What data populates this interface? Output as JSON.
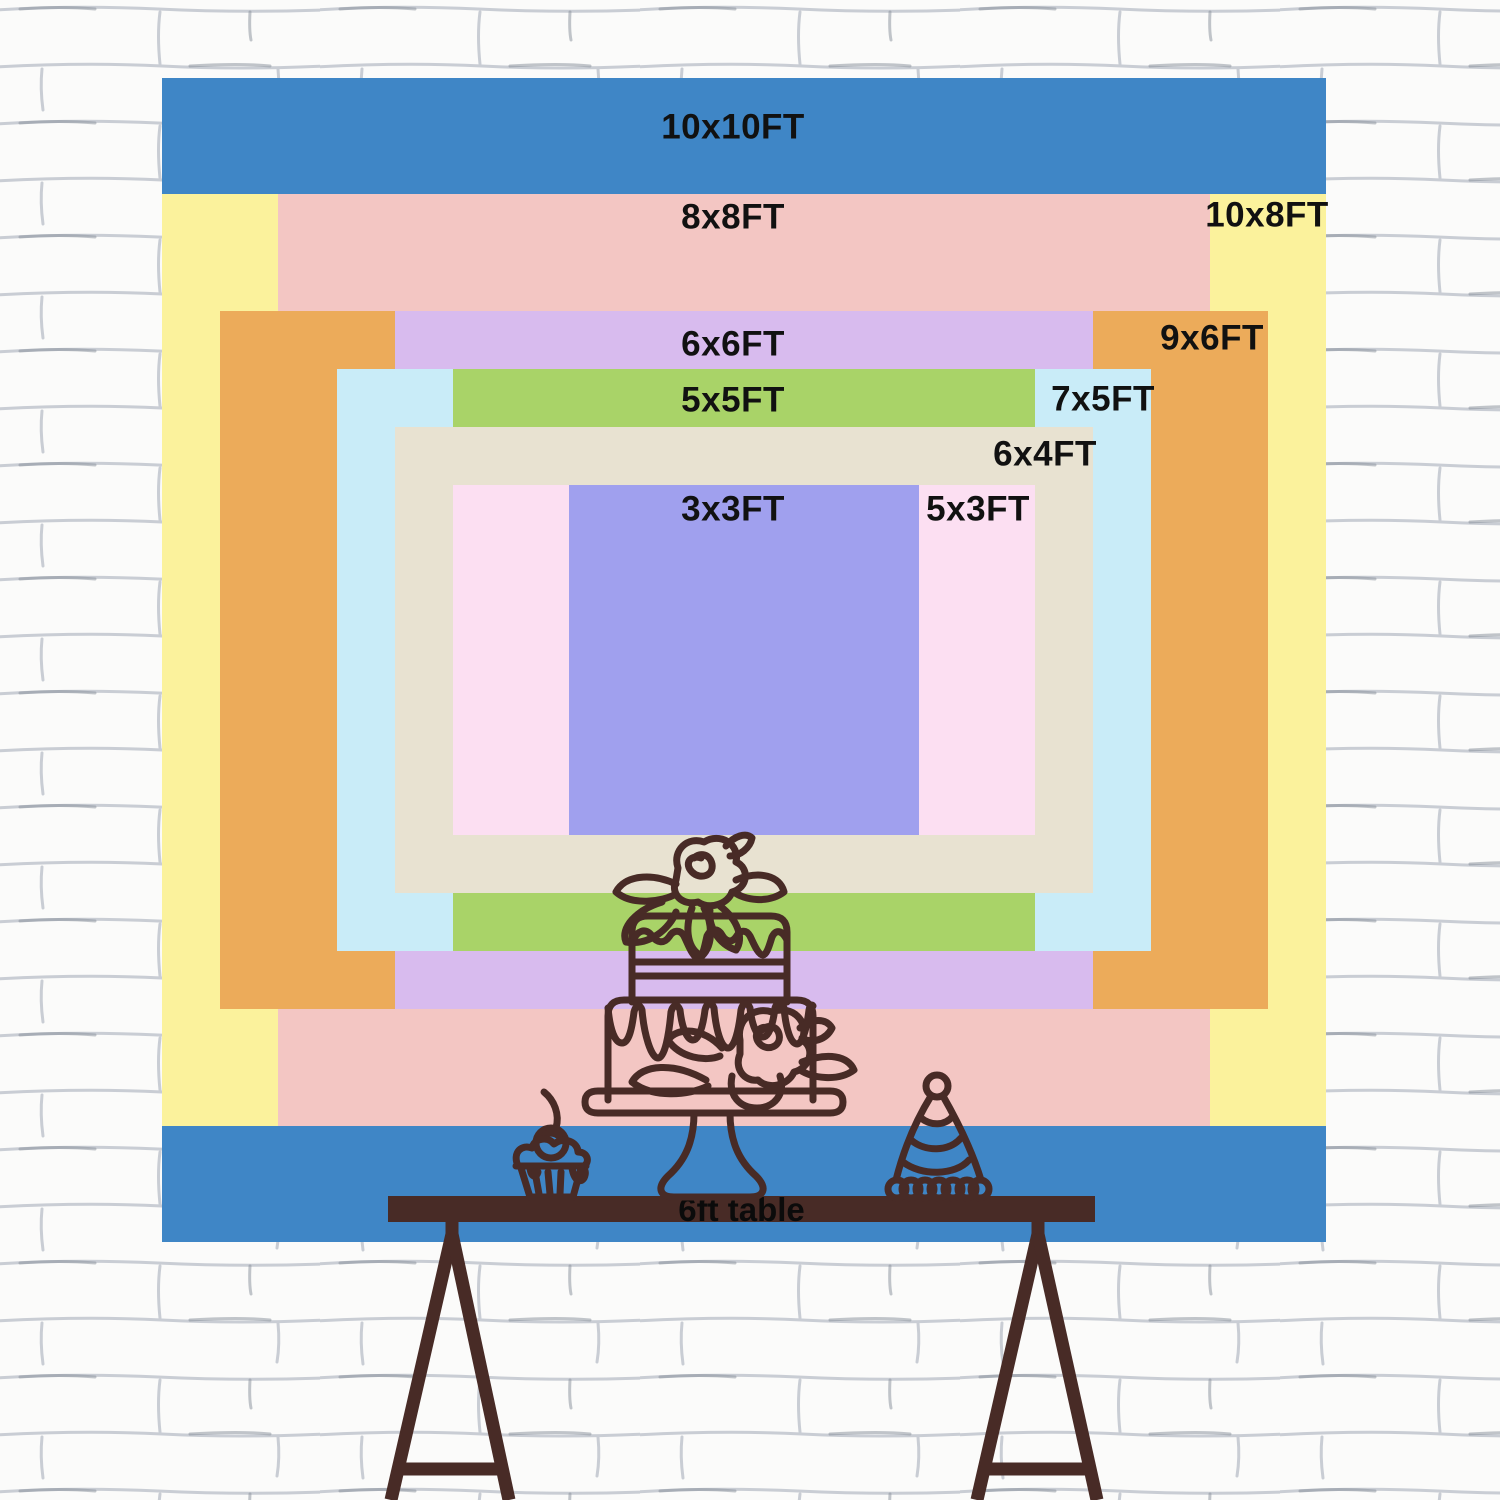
{
  "scene": {
    "backdrop": {
      "x": 162,
      "y": 78,
      "size": 1164,
      "px_per_ft": 116.4
    },
    "sizes": [
      {
        "id": "10x10",
        "w_ft": 10,
        "h_ft": 10,
        "color": "#3f86c6"
      },
      {
        "id": "10x8",
        "w_ft": 10,
        "h_ft": 8,
        "color": "#fbf29c"
      },
      {
        "id": "8x8",
        "w_ft": 8,
        "h_ft": 8,
        "color": "#f3c6c3"
      },
      {
        "id": "9x6",
        "w_ft": 9,
        "h_ft": 6,
        "color": "#ecab5a"
      },
      {
        "id": "6x6",
        "w_ft": 6,
        "h_ft": 6,
        "color": "#d8bbee"
      },
      {
        "id": "7x5",
        "w_ft": 7,
        "h_ft": 5,
        "color": "#c9ecf8"
      },
      {
        "id": "5x5",
        "w_ft": 5,
        "h_ft": 5,
        "color": "#a9d368"
      },
      {
        "id": "6x4",
        "w_ft": 6,
        "h_ft": 4,
        "color": "#e8e2d1"
      },
      {
        "id": "5x3",
        "w_ft": 5,
        "h_ft": 3,
        "color": "#fcdff2"
      },
      {
        "id": "3x3",
        "w_ft": 3,
        "h_ft": 3,
        "color": "#a0a0ee"
      }
    ],
    "size_labels": [
      {
        "for": "10x10",
        "text": "10x10FT",
        "x": 571,
        "y": 49
      },
      {
        "for": "8x8",
        "text": "8x8FT",
        "x": 571,
        "y": 139
      },
      {
        "for": "10x8",
        "text": "10x8FT",
        "x": 1105,
        "y": 137
      },
      {
        "for": "6x6",
        "text": "6x6FT",
        "x": 571,
        "y": 266
      },
      {
        "for": "9x6",
        "text": "9x6FT",
        "x": 1050,
        "y": 260
      },
      {
        "for": "5x5",
        "text": "5x5FT",
        "x": 571,
        "y": 322
      },
      {
        "for": "7x5",
        "text": "7x5FT",
        "x": 941,
        "y": 321
      },
      {
        "for": "6x4",
        "text": "6x4FT",
        "x": 883,
        "y": 376
      },
      {
        "for": "3x3",
        "text": "3x3FT",
        "x": 571,
        "y": 431
      },
      {
        "for": "5x3",
        "text": "5x3FT",
        "x": 816,
        "y": 431
      }
    ],
    "table": {
      "label": "6ft table"
    },
    "icons": [
      {
        "name": "cupcake-icon"
      },
      {
        "name": "birthday-cake-icon"
      },
      {
        "name": "party-hat-icon"
      }
    ],
    "colors": {
      "label_text": "#111111",
      "line_art": "#482b26",
      "table_bar": "#482b26",
      "wall_bg": "#fbfbfa",
      "wall_line": "#c9cdd4"
    }
  }
}
